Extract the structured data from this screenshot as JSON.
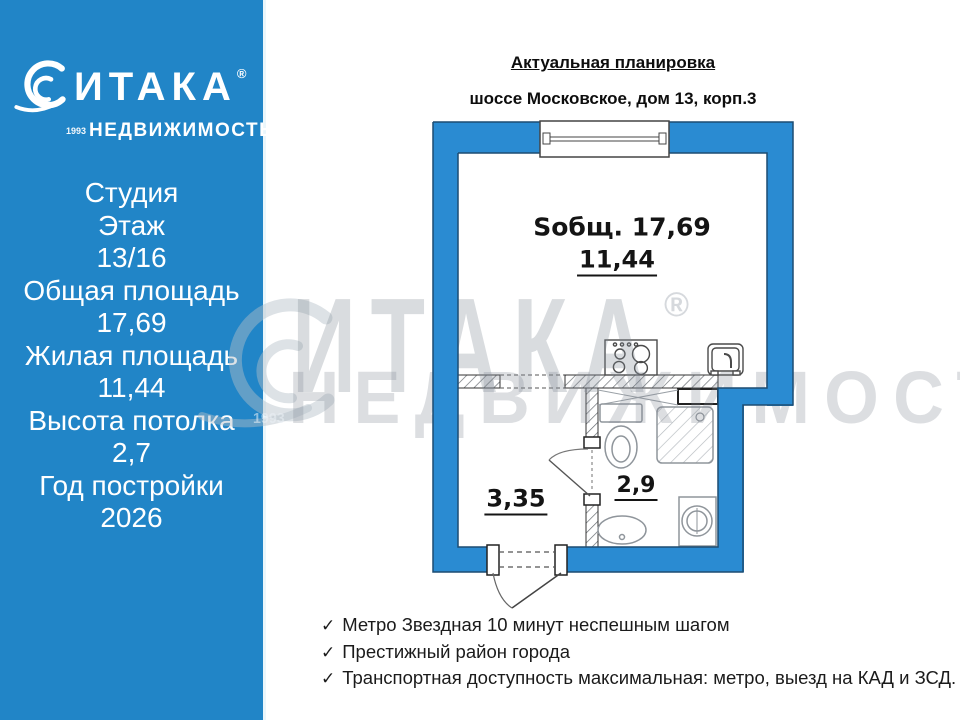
{
  "sidebar": {
    "logo": {
      "brand": "ИТАКА",
      "reg": "®",
      "year": "1993",
      "sub": "НЕДВИЖИМОСТЬ"
    },
    "lines": [
      "Студия",
      "Этаж",
      "13/16",
      "Общая площадь",
      "17,69",
      "Жилая площадь",
      "11,44",
      "Высота потолка",
      "2,7",
      "Год постройки",
      "2026"
    ]
  },
  "header": {
    "title": "Актуальная планировка",
    "address": "шоссе Московское, дом 13, корп.3"
  },
  "plan": {
    "total_label": "Sобщ. 17,69",
    "room_area": "11,44",
    "hall_area": "3,35",
    "bath_area": "2,9"
  },
  "features": [
    "Метро Звездная 10  минут неспешным шагом",
    "Престижный район города",
    "Транспортная доступность максимальная: метро, выезд на КАД и ЗСД."
  ],
  "check_glyph": "✓",
  "watermark": {
    "brand": "ИТАКА",
    "reg": "®",
    "year": "1993",
    "sub": "НЕДВИЖИМОСТЬ"
  },
  "colors": {
    "sidebar_blue": "#2185c7",
    "wall_blue": "#2a8bd2",
    "wall_outline": "#1c4c72",
    "fixture_gray": "#8f959b",
    "text_dark": "#141414"
  }
}
